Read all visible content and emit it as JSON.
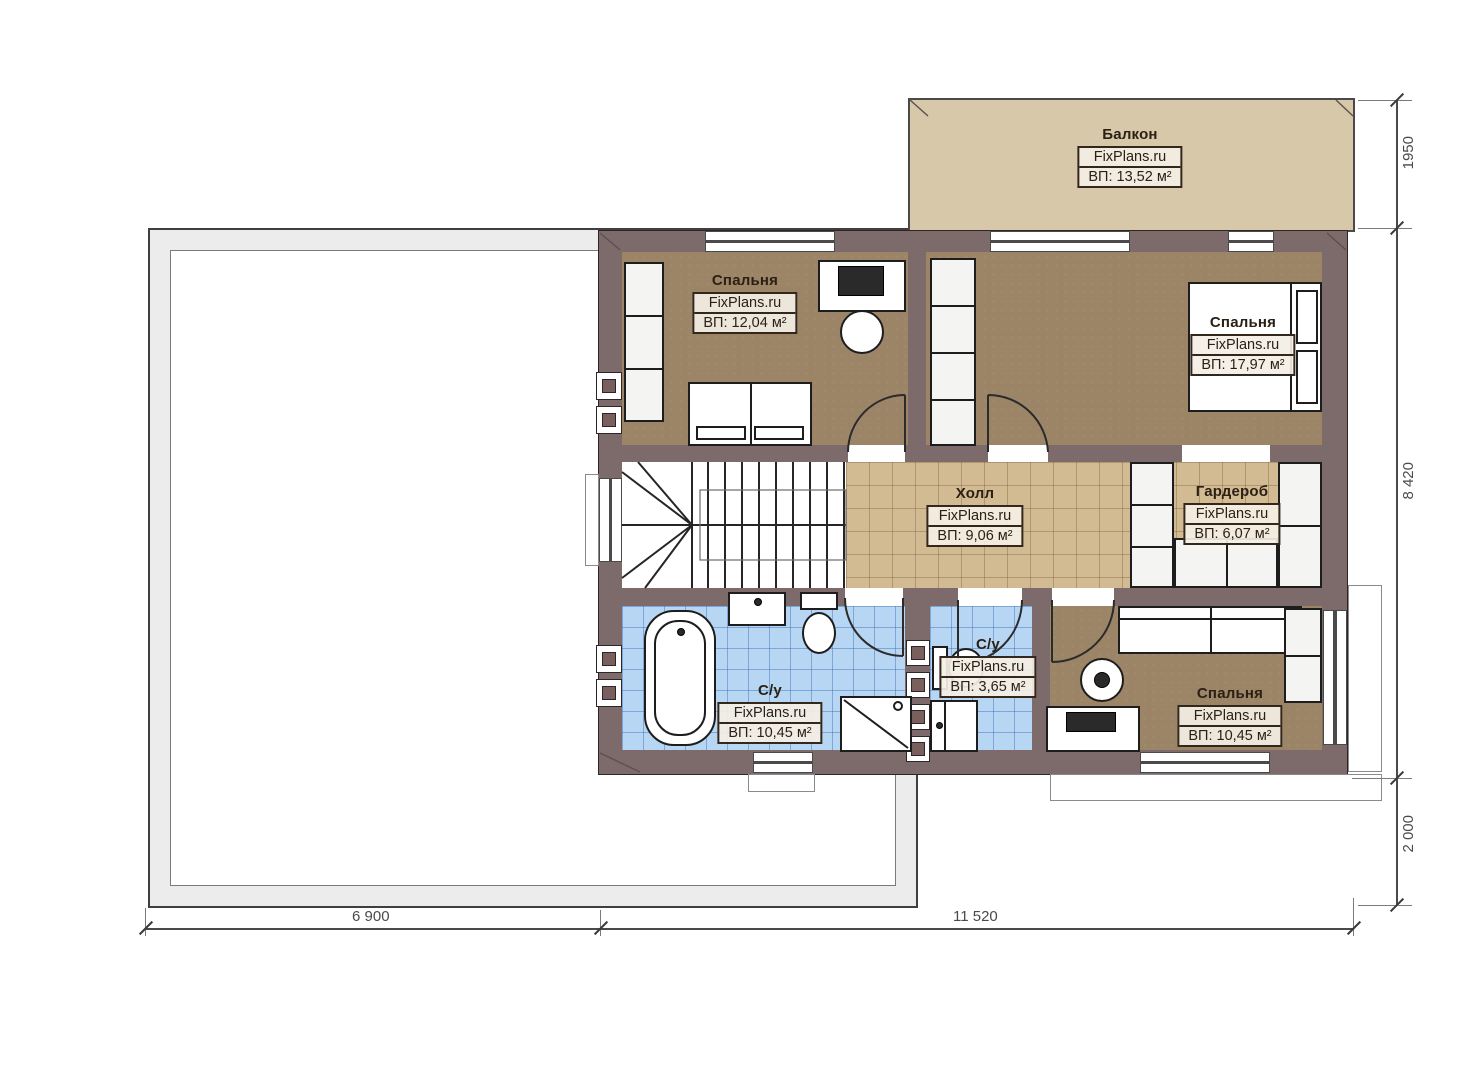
{
  "plan": {
    "rooms": [
      {
        "id": "balcony",
        "name": "Балкон",
        "watermark": "FixPlans.ru",
        "area": "ВП: 13,52 м²"
      },
      {
        "id": "bedroom-top-left",
        "name": "Спальня",
        "watermark": "FixPlans.ru",
        "area": "ВП: 12,04 м²"
      },
      {
        "id": "bedroom-top-right",
        "name": "Спальня",
        "watermark": "FixPlans.ru",
        "area": "ВП: 17,97 м²"
      },
      {
        "id": "hall",
        "name": "Холл",
        "watermark": "FixPlans.ru",
        "area": "ВП: 9,06 м²"
      },
      {
        "id": "wardrobe",
        "name": "Гардероб",
        "watermark": "FixPlans.ru",
        "area": "ВП: 6,07 м²"
      },
      {
        "id": "bathroom-main",
        "name": "С/у",
        "watermark": "FixPlans.ru",
        "area": "ВП: 10,45 м²"
      },
      {
        "id": "bathroom-small",
        "name": "С/у",
        "watermark": "FixPlans.ru",
        "area": "ВП: 3,65 м²"
      },
      {
        "id": "bedroom-bottom-right",
        "name": "Спальня",
        "watermark": "FixPlans.ru",
        "area": "ВП: 10,45 м²"
      }
    ],
    "dimensions": {
      "right": [
        "1950",
        "8 420",
        "2 000"
      ],
      "bottom": [
        "6 900",
        "11 520"
      ]
    },
    "palette": {
      "wall": "#7d6b6b",
      "bedroom_floor": "#9c8467",
      "hall_tile": "#d2bb92",
      "bath_tile": "#b7d6f3",
      "balcony": "#d6c8a8",
      "roof_band": "#ececec"
    }
  }
}
